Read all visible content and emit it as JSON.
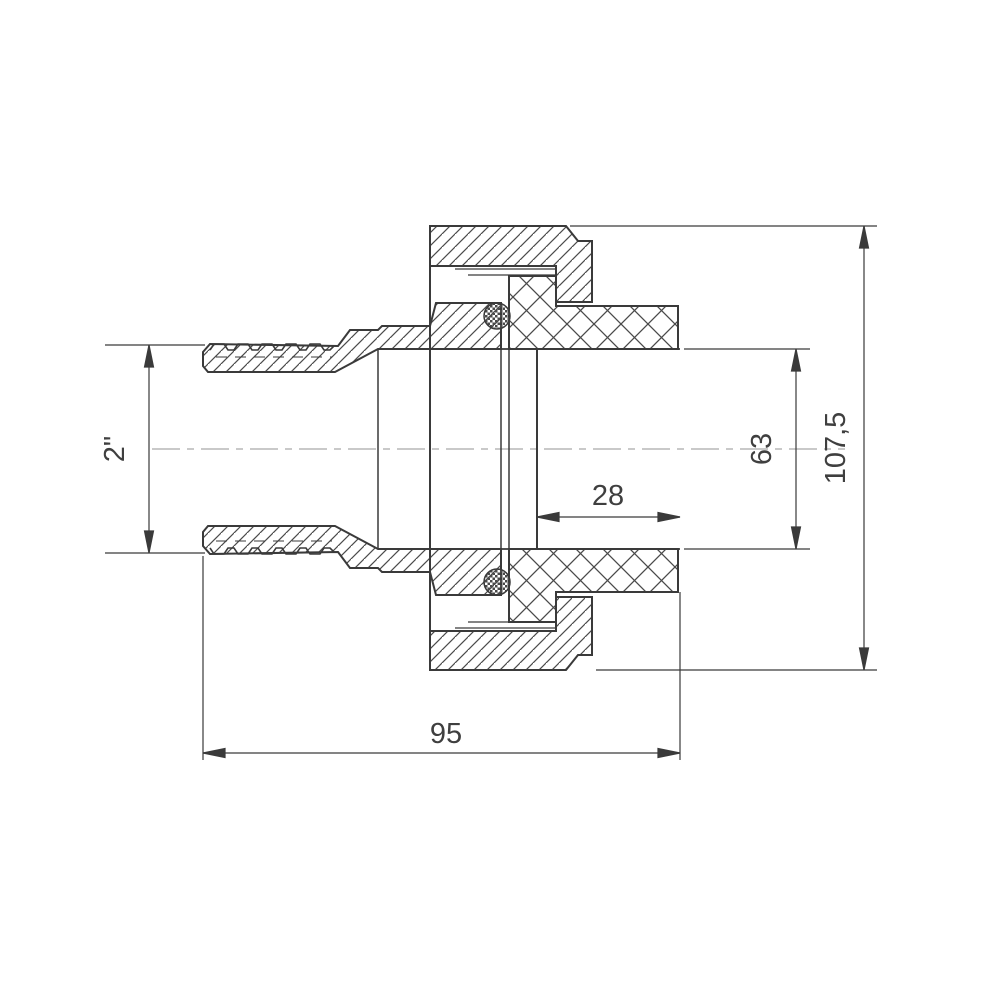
{
  "drawing": {
    "kind": "sectional technical drawing of pipe union fitting",
    "labels": {
      "thread_size": "2\"",
      "total_height": "107,5",
      "socket_inner_diameter": "63",
      "socket_depth": "28",
      "body_length": "95"
    },
    "colors": {
      "line": "#3a3a3a",
      "hatch": "#4a4a4a",
      "centerline": "#b7b7b7",
      "text": "#3f3f3f",
      "background": "#ffffff"
    }
  }
}
